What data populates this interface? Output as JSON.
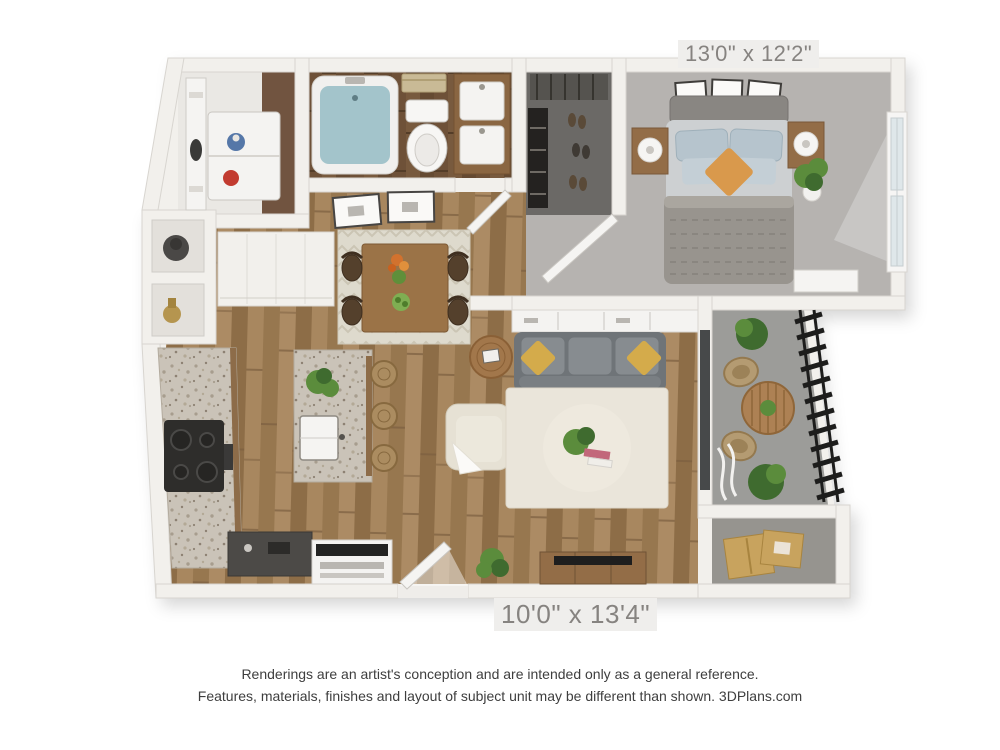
{
  "labels": {
    "bedroom_dimensions": "13'0\" x 12'2\"",
    "living_dimensions": "10'0\" x 13'4\""
  },
  "disclaimer": {
    "line1": "Renderings are an artist's conception and are intended only as a general reference.",
    "line2": "Features, materials, finishes and layout of subject unit may be different than shown. 3DPlans.com"
  },
  "floorplan": {
    "type": "apartment-3d-floor-plan",
    "rooms": [
      {
        "name": "bedroom",
        "dimensions": "13'0\" x 12'2\""
      },
      {
        "name": "living-dining-room",
        "dimensions": "10'0\" x 13'4\""
      },
      {
        "name": "kitchen"
      },
      {
        "name": "bathroom"
      },
      {
        "name": "walk-in-closet"
      },
      {
        "name": "laundry-closet"
      },
      {
        "name": "balcony"
      },
      {
        "name": "storage"
      },
      {
        "name": "entry"
      }
    ]
  },
  "colors": {
    "wall": "#f2f0ec",
    "wall_edge": "#d8d5d0",
    "wood": "#a2815c",
    "carpet": "#b6b3b0",
    "bath_floor": "#6e5138",
    "closet_floor": "#6b6966",
    "balcony_floor": "#9c9c99",
    "storage_floor": "#96948f",
    "granite": "#cac3b8",
    "sofa": "#6f7478",
    "sofa_cushion": "#878c90",
    "pillow_accent": "#d4ab4b",
    "pillow_orange": "#d9994c",
    "rug": "#eae5da",
    "chair_cream": "#e6e1d4",
    "bed_duvet": "#98948e",
    "bed_mattress": "#cdd0d2",
    "bed_pillow": "#b6c4cd",
    "headboard": "#898682",
    "furniture_wood": "#936d47",
    "plant": "#5b8c3c",
    "plant_dark": "#3f6b2f",
    "water": "#a3c4cb",
    "railing": "#1d1d1c",
    "box_tan": "#c8a35e",
    "label_text": "#868380",
    "label_bg": "#efeeec",
    "disclaimer_text": "#3e3e3e"
  }
}
